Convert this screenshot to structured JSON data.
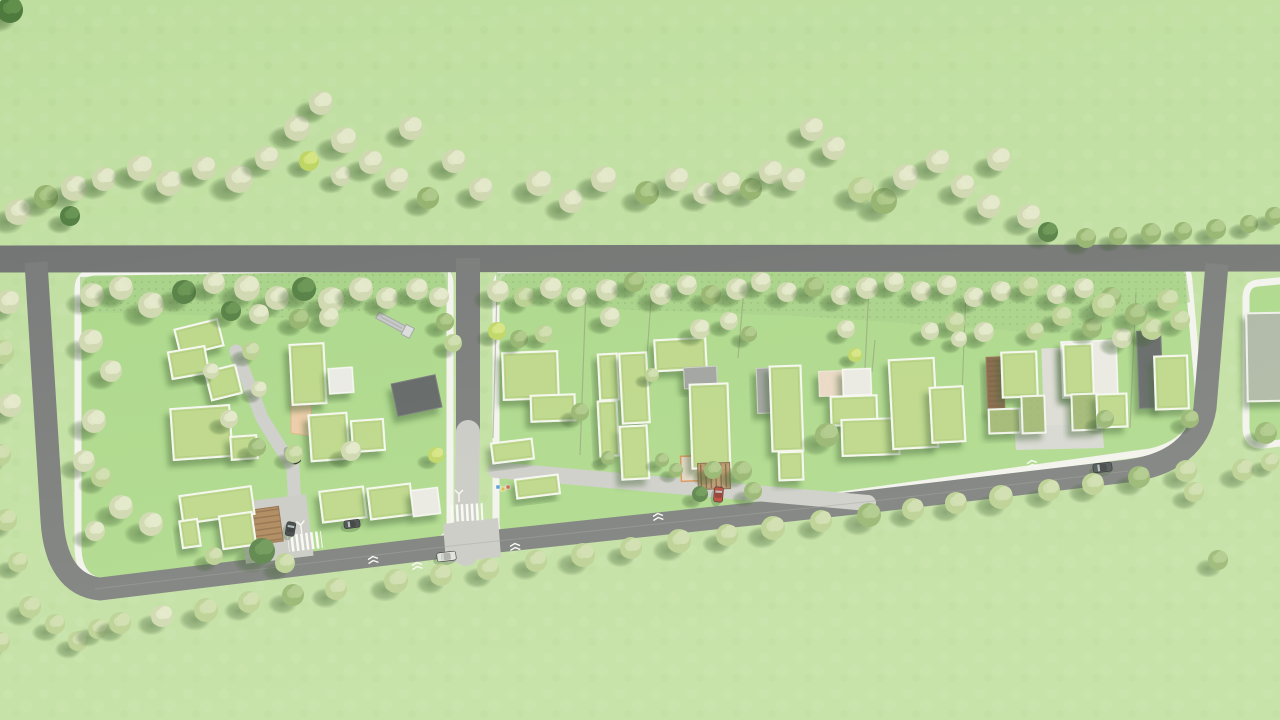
{
  "scene": {
    "width": 1280,
    "height": 720,
    "colors": {
      "grass": "#bede9f",
      "blockGrass": "#a9d787",
      "meadow": "#a2cd83",
      "roadTop": "#6c6e6f",
      "roadLoop": "#737576",
      "pavedLight": "#c7c7c5",
      "laneLight": "#cbcbc9",
      "curbWhite": "#f3f3f0",
      "centerLine": "#9a9c9a",
      "shadow": "#2f5222"
    }
  },
  "roofPalette": {
    "green": {
      "fill": "#b9d584",
      "stroke": "#f6f8f2",
      "sw": 2
    },
    "gray": {
      "fill": "#9a9c9b",
      "stroke": "#c9cac8",
      "sw": 1
    },
    "darkgray": {
      "fill": "#595d5e",
      "stroke": "#6e7273",
      "sw": 1
    },
    "white": {
      "fill": "#e9e9e5",
      "stroke": "#f8f8f5",
      "sw": 1.5
    },
    "sage": {
      "fill": "#a9b2a2",
      "stroke": "#eef0ea",
      "sw": 2
    },
    "wood": {
      "fill": "#7d5b3e",
      "stroke": "#8f6b4a",
      "sw": 1
    },
    "moss": {
      "fill": "#9cb36d",
      "stroke": "#f2f4ee",
      "sw": 2
    },
    "peach": {
      "fill": "#e8d5c2",
      "stroke": "#efe5d8",
      "sw": 1
    }
  },
  "treePalette": [
    {
      "base": "#cdd6ae",
      "light": "#e2e7c9"
    },
    {
      "base": "#b6cd8d",
      "light": "#ccdcab"
    },
    {
      "base": "#90b069",
      "light": "#a9c584"
    },
    {
      "base": "#4d7a3d",
      "light": "#61904c"
    },
    {
      "base": "#bcd45e",
      "light": "#d3e47e"
    }
  ],
  "blocks": [
    {
      "name": "residential-block-left",
      "path": "M96,272 L432,268 Q450,267 450,285 L450,522 Q450,540 432,542 L112,581 Q78,585 78,546 L78,290 Q78,272 96,272 Z"
    },
    {
      "name": "residential-block-main",
      "path": "M514,270 L1164,258 Q1188,257 1189,282 L1198,386 Q1203,440 1150,452 L518,540 Q496,543 496,523 L496,288 Q496,270 514,270 Z"
    },
    {
      "name": "residential-block-right",
      "path": "M1258,283 Q1246,284 1246,298 L1246,428 Q1247,447 1264,445 L1288,442 L1288,280 Z"
    }
  ],
  "meadowBands": [
    {
      "points": "80,277 448,269 448,300 300,318 80,312"
    },
    {
      "points": "496,273 1184,259 1190,302 1060,334 800,316 496,305"
    }
  ],
  "roads": [
    {
      "name": "main-road-top",
      "d": "M-5,259 L1285,258",
      "w": 27,
      "color": "roadTop"
    },
    {
      "name": "loop-road",
      "d": "M36,262 L52,520 Q56,584 100,589 L460,545 L865,502 L1128,471 Q1196,462 1205,408 L1217,264",
      "w": 23,
      "color": "roadLoop"
    },
    {
      "name": "internal-road",
      "d": "M468,258 L468,436",
      "w": 24,
      "color": "roadLoop"
    }
  ],
  "pavedWays": [
    {
      "name": "internal-road-paved",
      "d": "M468,432 L466,554",
      "w": 24,
      "color": "pavedLight"
    },
    {
      "name": "shared-lane",
      "d": "M496,470 L868,503",
      "w": 16,
      "color": "laneLight"
    },
    {
      "name": "driveway",
      "d": "M236,351 L262,418 L293,468 L296,532",
      "w": 13,
      "color": "laneLight"
    }
  ],
  "pavedPads": [
    {
      "name": "junction-pad",
      "points": "443,524 498,518 501,557 446,563",
      "color": "pavedLight"
    },
    {
      "name": "plaza",
      "rect": [
        242,
        498,
        68,
        62,
        -7
      ],
      "color": "pavedLight"
    },
    {
      "name": "courtyard-strip",
      "rect": [
        1043,
        348,
        26,
        96,
        -2
      ],
      "color": "#dad9d5"
    },
    {
      "name": "courtyard-pad",
      "points": "1014,426 1102,424 1104,448 1016,450",
      "color": "#d5d5d2"
    }
  ],
  "centerLine": "M95,589 L460,545 L865,502 L1128,471",
  "fences": [
    [
      586,
      290,
      580,
      455
    ],
    [
      652,
      286,
      646,
      370
    ],
    [
      744,
      288,
      738,
      358
    ],
    [
      869,
      286,
      862,
      430
    ],
    [
      875,
      340,
      872,
      372
    ],
    [
      897,
      360,
      894,
      410
    ],
    [
      966,
      290,
      960,
      445
    ],
    [
      1136,
      292,
      1130,
      428
    ],
    [
      497,
      290,
      493,
      438
    ]
  ],
  "crosswalks": [
    [
      449,
      504,
      34,
      17,
      -3
    ],
    [
      288,
      533,
      34,
      17,
      -7
    ]
  ],
  "markings": {
    "threeArrows": [
      [
        301,
        527,
        -7
      ],
      [
        459,
        496,
        0
      ]
    ],
    "chevrons": [
      [
        373,
        559,
        -7
      ],
      [
        417,
        565,
        -7
      ],
      [
        515,
        546,
        -5
      ],
      [
        658,
        516,
        -6
      ],
      [
        1032,
        463,
        -7
      ]
    ]
  },
  "buildings": [
    [
      177,
      324,
      44,
      27,
      -14,
      "green"
    ],
    [
      170,
      349,
      37,
      27,
      -10,
      "green"
    ],
    [
      208,
      368,
      31,
      29,
      -14,
      "green"
    ],
    [
      291,
      344,
      34,
      60,
      -3,
      "green"
    ],
    [
      172,
      407,
      59,
      51,
      -4,
      "green"
    ],
    [
      231,
      436,
      26,
      23,
      -4,
      "green"
    ],
    [
      310,
      414,
      38,
      46,
      -4,
      "green"
    ],
    [
      352,
      420,
      32,
      31,
      -4,
      "green"
    ],
    [
      394,
      379,
      45,
      33,
      -12,
      "darkgray"
    ],
    [
      329,
      368,
      24,
      25,
      -4,
      "white"
    ],
    [
      181,
      491,
      72,
      28,
      -8,
      "green"
    ],
    [
      221,
      514,
      33,
      33,
      -8,
      "green"
    ],
    [
      181,
      520,
      18,
      27,
      -8,
      "green"
    ],
    [
      321,
      489,
      44,
      31,
      -7,
      "green"
    ],
    [
      369,
      486,
      43,
      31,
      -7,
      "green"
    ],
    [
      412,
      489,
      27,
      26,
      -7,
      "white"
    ],
    [
      503,
      352,
      55,
      47,
      -2,
      "green"
    ],
    [
      531,
      395,
      44,
      26,
      -2,
      "green"
    ],
    [
      492,
      441,
      41,
      20,
      -7,
      "green"
    ],
    [
      516,
      477,
      43,
      19,
      -7,
      "green"
    ],
    [
      599,
      354,
      19,
      46,
      -3,
      "green"
    ],
    [
      599,
      401,
      19,
      55,
      -3,
      "green"
    ],
    [
      621,
      353,
      27,
      70,
      -3,
      "green"
    ],
    [
      621,
      426,
      27,
      53,
      -3,
      "green"
    ],
    [
      655,
      339,
      51,
      31,
      -3,
      "green"
    ],
    [
      684,
      367,
      33,
      21,
      -3,
      "gray"
    ],
    [
      691,
      384,
      38,
      84,
      -2,
      "green"
    ],
    [
      757,
      368,
      20,
      45,
      -2,
      "gray"
    ],
    [
      771,
      366,
      31,
      85,
      -2,
      "green"
    ],
    [
      779,
      452,
      24,
      28,
      -2,
      "green"
    ],
    [
      819,
      371,
      25,
      25,
      -2,
      "peach"
    ],
    [
      843,
      369,
      28,
      26,
      -2,
      "white"
    ],
    [
      831,
      396,
      46,
      29,
      -2,
      "green"
    ],
    [
      842,
      419,
      57,
      36,
      -2,
      "green"
    ],
    [
      891,
      359,
      45,
      89,
      -3,
      "green"
    ],
    [
      931,
      387,
      33,
      55,
      -3,
      "green"
    ],
    [
      987,
      357,
      17,
      55,
      -2,
      "wood"
    ],
    [
      1002,
      352,
      35,
      45,
      -2,
      "green"
    ],
    [
      989,
      409,
      31,
      24,
      -2,
      "moss"
    ],
    [
      1022,
      396,
      23,
      37,
      -2,
      "moss"
    ],
    [
      1062,
      341,
      55,
      56,
      -2,
      "white"
    ],
    [
      1064,
      344,
      29,
      51,
      -2,
      "green"
    ],
    [
      1072,
      394,
      25,
      36,
      -2,
      "moss"
    ],
    [
      1097,
      394,
      30,
      33,
      -2,
      "green"
    ],
    [
      1138,
      331,
      24,
      77,
      -2,
      "darkgray"
    ],
    [
      1155,
      356,
      33,
      53,
      -2,
      "green"
    ],
    [
      1247,
      313,
      40,
      88,
      -1,
      "sage"
    ]
  ],
  "structures": {
    "woodenDeck": [
      254,
      508,
      27,
      35,
      -8
    ],
    "pergola": [
      698,
      463,
      32,
      26,
      -2
    ],
    "peachPatio": "291,399 312,401 310,436 291,433",
    "peachUnit": [
      681,
      456,
      20,
      25,
      -2
    ],
    "slide": {
      "x": 379,
      "y": 312,
      "len": 34,
      "rot": 28
    },
    "bins": [
      [
        217,
        424,
        "#4a90d9"
      ],
      [
        222,
        427,
        "#e0b23c"
      ],
      [
        227,
        425,
        "#d05c4a"
      ],
      [
        496,
        485,
        "#4a90d9"
      ],
      [
        501,
        487,
        "#e0b23c"
      ],
      [
        506,
        485,
        "#d05c4a"
      ]
    ]
  },
  "cars": [
    [
      286,
      452,
      16,
      8,
      58,
      "#26282b"
    ],
    [
      437,
      552,
      19,
      9,
      -7,
      "#e0e0de"
    ],
    [
      714,
      487,
      9,
      15,
      4,
      "#b8392d"
    ],
    [
      1093,
      463,
      19,
      9,
      -7,
      "#41464b"
    ],
    [
      286,
      522,
      9,
      14,
      10,
      "#33383c"
    ],
    [
      344,
      520,
      16,
      8,
      -7,
      "#3a3f43"
    ]
  ],
  "trees": [
    [
      10,
      10,
      13,
      3
    ],
    [
      18,
      212,
      13,
      0
    ],
    [
      46,
      197,
      12,
      2
    ],
    [
      74,
      188,
      13,
      0
    ],
    [
      104,
      179,
      12,
      0
    ],
    [
      70,
      216,
      10,
      3
    ],
    [
      140,
      168,
      13,
      0
    ],
    [
      169,
      183,
      13,
      0
    ],
    [
      204,
      168,
      12,
      0
    ],
    [
      239,
      179,
      14,
      0
    ],
    [
      267,
      158,
      12,
      0
    ],
    [
      297,
      128,
      13,
      0
    ],
    [
      321,
      103,
      12,
      0
    ],
    [
      309,
      161,
      10,
      4
    ],
    [
      344,
      140,
      13,
      0
    ],
    [
      341,
      176,
      10,
      0
    ],
    [
      371,
      162,
      12,
      0
    ],
    [
      397,
      179,
      12,
      0
    ],
    [
      411,
      128,
      12,
      0
    ],
    [
      428,
      198,
      11,
      2
    ],
    [
      454,
      161,
      12,
      0
    ],
    [
      481,
      189,
      12,
      0
    ],
    [
      539,
      183,
      13,
      0
    ],
    [
      571,
      201,
      12,
      0
    ],
    [
      604,
      179,
      13,
      0
    ],
    [
      647,
      193,
      12,
      2
    ],
    [
      677,
      179,
      12,
      0
    ],
    [
      704,
      193,
      11,
      0
    ],
    [
      729,
      183,
      12,
      0
    ],
    [
      751,
      189,
      11,
      2
    ],
    [
      771,
      172,
      12,
      0
    ],
    [
      794,
      179,
      12,
      0
    ],
    [
      812,
      129,
      12,
      0
    ],
    [
      834,
      148,
      12,
      0
    ],
    [
      861,
      190,
      13,
      1
    ],
    [
      884,
      201,
      13,
      2
    ],
    [
      906,
      177,
      13,
      0
    ],
    [
      938,
      161,
      12,
      0
    ],
    [
      963,
      186,
      12,
      0
    ],
    [
      989,
      206,
      12,
      0
    ],
    [
      999,
      159,
      12,
      0
    ],
    [
      1029,
      216,
      12,
      0
    ],
    [
      1048,
      232,
      10,
      3
    ],
    [
      1086,
      238,
      10,
      2
    ],
    [
      1118,
      236,
      9,
      2
    ],
    [
      1151,
      233,
      10,
      2
    ],
    [
      1183,
      231,
      9,
      2
    ],
    [
      1216,
      229,
      10,
      2
    ],
    [
      1249,
      224,
      9,
      2
    ],
    [
      1274,
      216,
      9,
      2
    ],
    [
      8,
      302,
      12,
      0
    ],
    [
      2,
      352,
      12,
      1
    ],
    [
      10,
      405,
      12,
      0
    ],
    [
      0,
      455,
      11,
      1
    ],
    [
      6,
      520,
      11,
      1
    ],
    [
      18,
      562,
      10,
      1
    ],
    [
      30,
      607,
      11,
      1
    ],
    [
      55,
      624,
      10,
      1
    ],
    [
      0,
      642,
      10,
      1
    ],
    [
      78,
      641,
      10,
      1
    ],
    [
      98,
      629,
      10,
      1
    ],
    [
      120,
      623,
      11,
      1
    ],
    [
      162,
      616,
      11,
      0
    ],
    [
      206,
      610,
      12,
      1
    ],
    [
      249,
      602,
      11,
      1
    ],
    [
      293,
      595,
      11,
      2
    ],
    [
      336,
      589,
      11,
      1
    ],
    [
      396,
      581,
      12,
      1
    ],
    [
      441,
      575,
      11,
      1
    ],
    [
      488,
      569,
      11,
      1
    ],
    [
      536,
      561,
      11,
      1
    ],
    [
      583,
      555,
      12,
      1
    ],
    [
      631,
      548,
      11,
      1
    ],
    [
      679,
      541,
      12,
      1
    ],
    [
      727,
      535,
      11,
      1
    ],
    [
      773,
      528,
      12,
      1
    ],
    [
      821,
      521,
      11,
      1
    ],
    [
      869,
      515,
      12,
      2
    ],
    [
      913,
      509,
      11,
      1
    ],
    [
      956,
      503,
      11,
      1
    ],
    [
      1001,
      497,
      12,
      1
    ],
    [
      1049,
      490,
      11,
      1
    ],
    [
      1093,
      484,
      11,
      1
    ],
    [
      1139,
      477,
      11,
      2
    ],
    [
      1186,
      471,
      11,
      1
    ],
    [
      1266,
      433,
      11,
      2
    ],
    [
      1243,
      470,
      11,
      1
    ],
    [
      1194,
      492,
      10,
      1
    ],
    [
      1270,
      462,
      9,
      1
    ],
    [
      92,
      295,
      12,
      0
    ],
    [
      121,
      288,
      12,
      0
    ],
    [
      151,
      305,
      13,
      0
    ],
    [
      184,
      292,
      12,
      3
    ],
    [
      214,
      283,
      11,
      0
    ],
    [
      247,
      288,
      13,
      0
    ],
    [
      277,
      298,
      12,
      0
    ],
    [
      304,
      289,
      12,
      3
    ],
    [
      331,
      300,
      13,
      0
    ],
    [
      361,
      289,
      12,
      0
    ],
    [
      387,
      298,
      11,
      0
    ],
    [
      417,
      289,
      11,
      0
    ],
    [
      439,
      297,
      10,
      0
    ],
    [
      299,
      319,
      10,
      2
    ],
    [
      329,
      317,
      10,
      0
    ],
    [
      91,
      341,
      12,
      0
    ],
    [
      111,
      371,
      11,
      0
    ],
    [
      94,
      421,
      12,
      0
    ],
    [
      84,
      461,
      11,
      0
    ],
    [
      101,
      477,
      10,
      1
    ],
    [
      121,
      507,
      12,
      0
    ],
    [
      151,
      524,
      12,
      0
    ],
    [
      95,
      531,
      10,
      0
    ],
    [
      229,
      419,
      9,
      0
    ],
    [
      257,
      447,
      9,
      2
    ],
    [
      351,
      451,
      10,
      0
    ],
    [
      294,
      454,
      9,
      1
    ],
    [
      251,
      351,
      9,
      1
    ],
    [
      211,
      371,
      8,
      0
    ],
    [
      259,
      389,
      8,
      0
    ],
    [
      231,
      311,
      10,
      3
    ],
    [
      259,
      314,
      10,
      0
    ],
    [
      262,
      551,
      13,
      3
    ],
    [
      285,
      563,
      10,
      1
    ],
    [
      214,
      556,
      9,
      1
    ],
    [
      436,
      455,
      8,
      4
    ],
    [
      453,
      343,
      9,
      1
    ],
    [
      445,
      322,
      9,
      2
    ],
    [
      498,
      291,
      11,
      0
    ],
    [
      524,
      297,
      10,
      1
    ],
    [
      551,
      288,
      11,
      0
    ],
    [
      577,
      297,
      10,
      0
    ],
    [
      607,
      290,
      11,
      0
    ],
    [
      634,
      282,
      10,
      2
    ],
    [
      661,
      294,
      11,
      0
    ],
    [
      687,
      285,
      10,
      0
    ],
    [
      711,
      295,
      10,
      2
    ],
    [
      737,
      289,
      11,
      0
    ],
    [
      761,
      282,
      10,
      0
    ],
    [
      787,
      292,
      10,
      0
    ],
    [
      814,
      287,
      10,
      2
    ],
    [
      841,
      295,
      10,
      0
    ],
    [
      867,
      288,
      11,
      0
    ],
    [
      894,
      282,
      10,
      0
    ],
    [
      921,
      291,
      10,
      0
    ],
    [
      947,
      285,
      10,
      0
    ],
    [
      974,
      297,
      10,
      0
    ],
    [
      1001,
      291,
      10,
      0
    ],
    [
      1029,
      286,
      10,
      1
    ],
    [
      1057,
      294,
      10,
      0
    ],
    [
      1084,
      288,
      10,
      0
    ],
    [
      1111,
      297,
      10,
      2
    ],
    [
      955,
      322,
      10,
      1
    ],
    [
      984,
      332,
      10,
      0
    ],
    [
      1062,
      316,
      10,
      1
    ],
    [
      1092,
      328,
      10,
      2
    ],
    [
      1122,
      338,
      10,
      0
    ],
    [
      1152,
      329,
      11,
      1
    ],
    [
      1180,
      320,
      10,
      1
    ],
    [
      1104,
      305,
      12,
      1
    ],
    [
      1136,
      314,
      11,
      2
    ],
    [
      1168,
      300,
      11,
      1
    ],
    [
      497,
      331,
      9,
      4
    ],
    [
      519,
      339,
      9,
      2
    ],
    [
      544,
      334,
      9,
      1
    ],
    [
      610,
      317,
      10,
      0
    ],
    [
      700,
      329,
      10,
      0
    ],
    [
      729,
      321,
      9,
      0
    ],
    [
      749,
      334,
      8,
      2
    ],
    [
      846,
      329,
      9,
      0
    ],
    [
      930,
      331,
      9,
      0
    ],
    [
      959,
      339,
      8,
      0
    ],
    [
      742,
      471,
      10,
      2
    ],
    [
      753,
      491,
      9,
      2
    ],
    [
      700,
      494,
      8,
      3
    ],
    [
      662,
      460,
      7,
      2
    ],
    [
      676,
      470,
      7,
      2
    ],
    [
      608,
      458,
      7,
      2
    ],
    [
      580,
      412,
      9,
      2
    ],
    [
      652,
      375,
      7,
      1
    ],
    [
      827,
      435,
      12,
      2
    ],
    [
      855,
      355,
      7,
      4
    ],
    [
      1035,
      331,
      9,
      1
    ],
    [
      1105,
      419,
      9,
      2
    ],
    [
      1190,
      419,
      9,
      2
    ],
    [
      713,
      470,
      9,
      2
    ],
    [
      1218,
      560,
      10,
      2
    ]
  ]
}
